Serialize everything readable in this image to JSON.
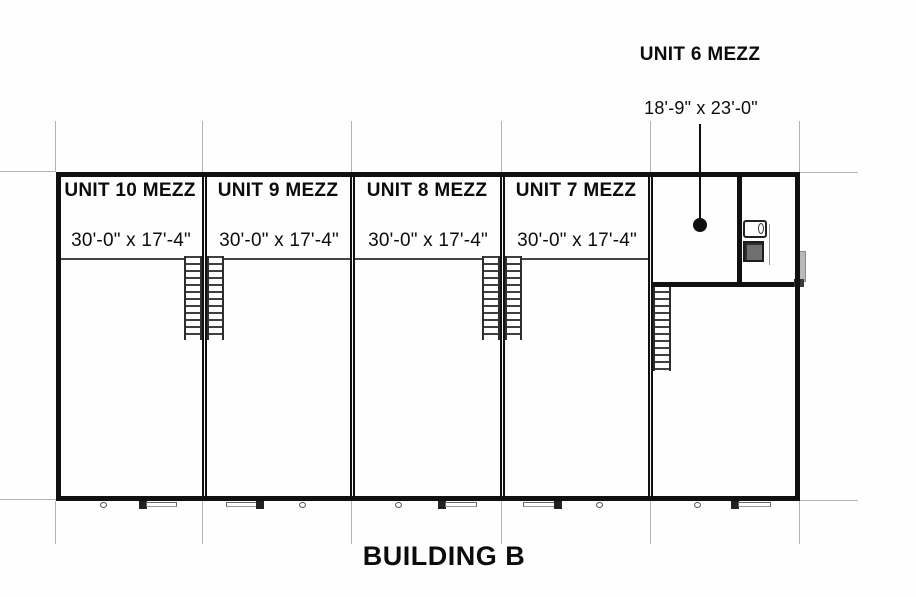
{
  "document": {
    "type": "architectural floor plan",
    "building_title": "BUILDING B"
  },
  "units": [
    {
      "name": "UNIT 10 MEZZ",
      "dimensions": "30'-0\" x 17'-4\""
    },
    {
      "name": "UNIT 9 MEZZ",
      "dimensions": "30'-0\" x 17'-4\""
    },
    {
      "name": "UNIT 8 MEZZ",
      "dimensions": "30'-0\" x 17'-4\""
    },
    {
      "name": "UNIT 7 MEZZ",
      "dimensions": "30'-0\" x 17'-4\""
    },
    {
      "name": "UNIT 6 MEZZ",
      "dimensions": "18'-9\" x 23'-0\""
    }
  ],
  "features": {
    "stairs_count": 5,
    "unit6_bathroom": true,
    "leader_dot": "callout target inside Unit 6 mezzanine"
  },
  "colors": {
    "wall": "#101010",
    "gridline": "#b3b3b3",
    "text": "#0c0c0c",
    "background": "#fefefe"
  }
}
